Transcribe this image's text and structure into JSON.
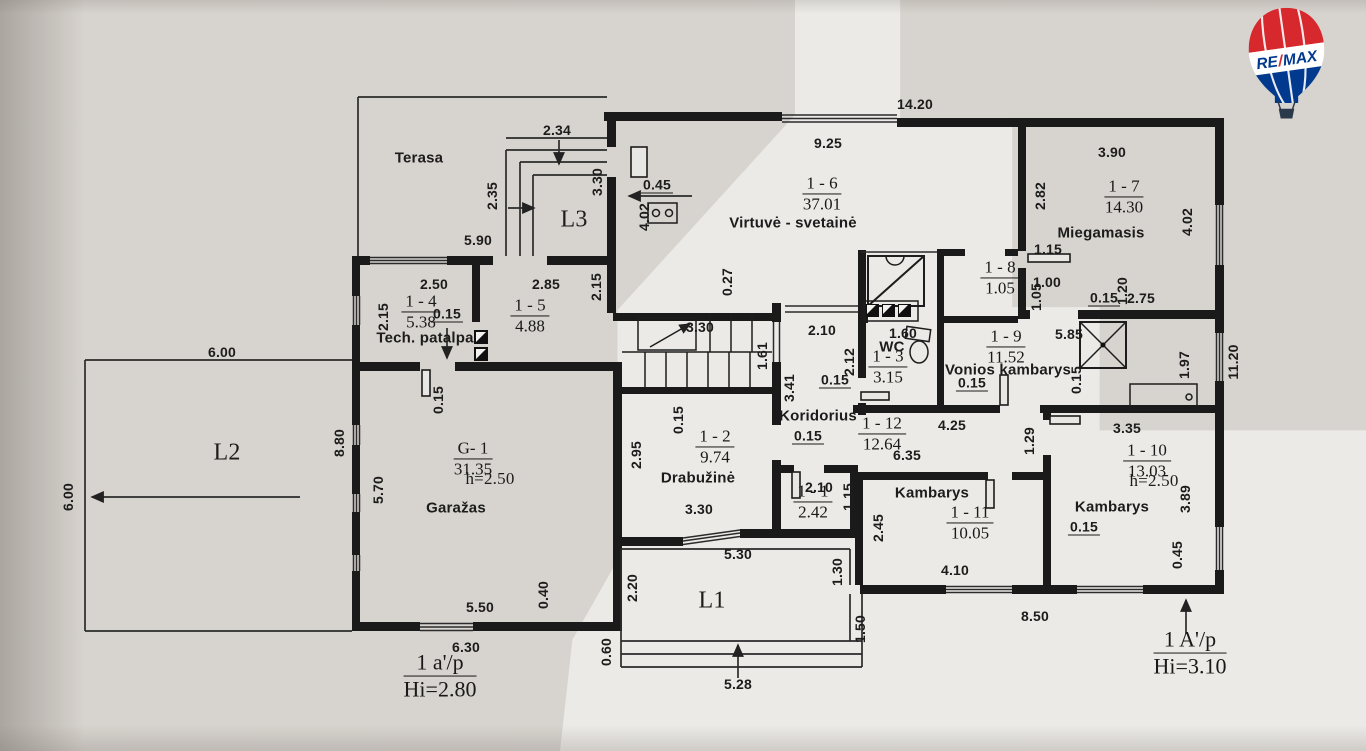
{
  "logo": {
    "re": "RE",
    "slash": "/",
    "max": "MAX",
    "red": "#d7282e",
    "blue": "#00398e",
    "white": "#ffffff",
    "basket": "#2b3a4a"
  },
  "plan": {
    "rooms": [
      {
        "code": "1 - 1",
        "area": "2.42"
      },
      {
        "code": "1 - 2",
        "area": "9.74",
        "name": "Drabužinė"
      },
      {
        "code": "1 - 3",
        "area": "3.15",
        "name": "WC"
      },
      {
        "code": "1 - 4",
        "area": "5.38",
        "name": "Tech. patalpa"
      },
      {
        "code": "1 - 5",
        "area": "4.88"
      },
      {
        "code": "1 - 6",
        "area": "37.01",
        "name": "Virtuvė - svetainė"
      },
      {
        "code": "1 - 7",
        "area": "14.30",
        "name": "Miegamasis"
      },
      {
        "code": "1 - 8",
        "area": "1.05"
      },
      {
        "code": "1 - 9",
        "area": "11.52",
        "name": "Vonios kambarys"
      },
      {
        "code": "1 - 10",
        "area": "13.03",
        "name": "Kambarys",
        "height": "h=2.50"
      },
      {
        "code": "1 - 11",
        "area": "10.05",
        "name": "Kambarys"
      },
      {
        "code": "1 - 12",
        "area": "12.64",
        "name": "Koridorius"
      },
      {
        "code": "G- 1",
        "area": "31.35",
        "name": "Garažas",
        "height": "h=2.50"
      }
    ],
    "zones": [
      "Terasa",
      "L1",
      "L2",
      "L3"
    ],
    "floor_annotations": [
      {
        "label": "1 a'/p",
        "height": "Hi=2.80"
      },
      {
        "label": "1 A'/p",
        "height": "Hi=3.10"
      }
    ],
    "texts": [
      {
        "t": "14.20",
        "x": 915,
        "y": 104
      },
      {
        "t": "2.34",
        "x": 557,
        "y": 130
      },
      {
        "t": "9.25",
        "x": 828,
        "y": 143
      },
      {
        "t": "3.90",
        "x": 1112,
        "y": 152
      },
      {
        "t": "2.35",
        "x": 492,
        "y": 196,
        "v": 1
      },
      {
        "t": "3.30",
        "x": 597,
        "y": 182,
        "v": 1
      },
      {
        "t": "0.45",
        "x": 657,
        "y": 185,
        "u": 1
      },
      {
        "t": "2.82",
        "x": 1040,
        "y": 196,
        "v": 1
      },
      {
        "t": "4.02",
        "x": 644,
        "y": 217,
        "v": 1
      },
      {
        "t": "4.02",
        "x": 1187,
        "y": 222,
        "v": 1
      },
      {
        "t": "5.90",
        "x": 478,
        "y": 240
      },
      {
        "t": "1.15",
        "x": 1048,
        "y": 249
      },
      {
        "t": "1.00",
        "x": 1047,
        "y": 282
      },
      {
        "t": "2.50",
        "x": 434,
        "y": 284
      },
      {
        "t": "2.85",
        "x": 546,
        "y": 284
      },
      {
        "t": "2.15",
        "x": 596,
        "y": 287,
        "v": 1
      },
      {
        "t": "1.05",
        "x": 1036,
        "y": 297,
        "v": 1
      },
      {
        "t": "1.20",
        "x": 1122,
        "y": 291,
        "v": 1
      },
      {
        "t": "0.15",
        "x": 1104,
        "y": 298,
        "u": 1
      },
      {
        "t": "2.75",
        "x": 1141,
        "y": 298
      },
      {
        "t": "0.27",
        "x": 727,
        "y": 282,
        "v": 1
      },
      {
        "t": "0.15",
        "x": 447,
        "y": 314,
        "u": 1
      },
      {
        "t": "2.15",
        "x": 383,
        "y": 317,
        "v": 1
      },
      {
        "t": "6.00",
        "x": 222,
        "y": 352
      },
      {
        "t": "3.30",
        "x": 700,
        "y": 327
      },
      {
        "t": "2.10",
        "x": 822,
        "y": 330
      },
      {
        "t": "1.60",
        "x": 903,
        "y": 333
      },
      {
        "t": "1.61",
        "x": 762,
        "y": 356,
        "v": 1
      },
      {
        "t": "2.12",
        "x": 849,
        "y": 362,
        "v": 1
      },
      {
        "t": "0.15",
        "x": 835,
        "y": 380,
        "u": 1
      },
      {
        "t": "5.85",
        "x": 1069,
        "y": 334
      },
      {
        "t": "0.15",
        "x": 972,
        "y": 383,
        "u": 1
      },
      {
        "t": "0.15",
        "x": 1076,
        "y": 380,
        "v": 1
      },
      {
        "t": "1.97",
        "x": 1184,
        "y": 365,
        "v": 1
      },
      {
        "t": "11.20",
        "x": 1233,
        "y": 362,
        "v": 1
      },
      {
        "t": "3.41",
        "x": 789,
        "y": 388,
        "v": 1
      },
      {
        "t": "0.15",
        "x": 808,
        "y": 436,
        "u": 1
      },
      {
        "t": "6.35",
        "x": 907,
        "y": 455
      },
      {
        "t": "4.25",
        "x": 952,
        "y": 425
      },
      {
        "t": "1.29",
        "x": 1029,
        "y": 441,
        "v": 1
      },
      {
        "t": "3.35",
        "x": 1127,
        "y": 428
      },
      {
        "t": "8.80",
        "x": 339,
        "y": 443,
        "v": 1
      },
      {
        "t": "6.00",
        "x": 68,
        "y": 497,
        "v": 1
      },
      {
        "t": "0.15",
        "x": 438,
        "y": 400,
        "v": 1
      },
      {
        "t": "5.70",
        "x": 378,
        "y": 490,
        "v": 1
      },
      {
        "t": "0.15",
        "x": 678,
        "y": 420,
        "v": 1
      },
      {
        "t": "2.95",
        "x": 636,
        "y": 455,
        "v": 1
      },
      {
        "t": "3.30",
        "x": 699,
        "y": 509
      },
      {
        "t": "2.10",
        "x": 819,
        "y": 487
      },
      {
        "t": "1.15",
        "x": 848,
        "y": 497,
        "v": 1
      },
      {
        "t": "2.45",
        "x": 878,
        "y": 528,
        "v": 1
      },
      {
        "t": "4.10",
        "x": 955,
        "y": 570
      },
      {
        "t": "0.15",
        "x": 1084,
        "y": 527,
        "u": 1
      },
      {
        "t": "3.89",
        "x": 1185,
        "y": 499,
        "v": 1
      },
      {
        "t": "0.45",
        "x": 1177,
        "y": 555,
        "v": 1
      },
      {
        "t": "1.30",
        "x": 837,
        "y": 572,
        "v": 1
      },
      {
        "t": "2.20",
        "x": 632,
        "y": 588,
        "v": 1
      },
      {
        "t": "1.50",
        "x": 860,
        "y": 629,
        "v": 1
      },
      {
        "t": "0.60",
        "x": 606,
        "y": 652,
        "v": 1
      },
      {
        "t": "5.50",
        "x": 480,
        "y": 607
      },
      {
        "t": "0.40",
        "x": 543,
        "y": 595,
        "v": 1
      },
      {
        "t": "6.30",
        "x": 466,
        "y": 647
      },
      {
        "t": "5.30",
        "x": 738,
        "y": 554
      },
      {
        "t": "5.28",
        "x": 738,
        "y": 684
      },
      {
        "t": "8.50",
        "x": 1035,
        "y": 616
      },
      {
        "t": "Terasa",
        "x": 419,
        "y": 158,
        "k": "room"
      },
      {
        "t": "Virtuvė  -  svetainė",
        "x": 793,
        "y": 223,
        "k": "room"
      },
      {
        "t": "Miegamasis",
        "x": 1101,
        "y": 233,
        "k": "room"
      },
      {
        "t": "Tech. patalpa",
        "x": 425,
        "y": 338,
        "k": "room"
      },
      {
        "t": "WC",
        "x": 892,
        "y": 347,
        "k": "room"
      },
      {
        "t": "Vonios kambarys",
        "x": 1008,
        "y": 370,
        "k": "room"
      },
      {
        "t": "Koridorius",
        "x": 818,
        "y": 416,
        "k": "room"
      },
      {
        "t": "Drabužinė",
        "x": 698,
        "y": 478,
        "k": "room"
      },
      {
        "t": "Garažas",
        "x": 456,
        "y": 508,
        "k": "room"
      },
      {
        "t": "Kambarys",
        "x": 932,
        "y": 493,
        "k": "room"
      },
      {
        "t": "Kambarys",
        "x": 1112,
        "y": 507,
        "k": "room"
      },
      {
        "t": "L3",
        "x": 574,
        "y": 220,
        "k": "zone"
      },
      {
        "t": "L2",
        "x": 227,
        "y": 453,
        "k": "zone"
      },
      {
        "t": "L1",
        "x": 712,
        "y": 601,
        "k": "zone"
      },
      {
        "t": "h=2.50",
        "x": 490,
        "y": 479,
        "k": "hh"
      },
      {
        "t": "h=2.50",
        "x": 1154,
        "y": 481,
        "k": "hh"
      }
    ],
    "fractions": [
      {
        "a": "1 - 6",
        "b": "37.01",
        "x": 822,
        "y": 194
      },
      {
        "a": "1 - 7",
        "b": "14.30",
        "x": 1124,
        "y": 197
      },
      {
        "a": "1 - 8",
        "b": "1.05",
        "x": 1000,
        "y": 278
      },
      {
        "a": "1 - 4",
        "b": "5.38",
        "x": 421,
        "y": 312
      },
      {
        "a": "1 - 5",
        "b": "4.88",
        "x": 530,
        "y": 316
      },
      {
        "a": "1 - 3",
        "b": "3.15",
        "x": 888,
        "y": 367
      },
      {
        "a": "1 - 9",
        "b": "11.52",
        "x": 1006,
        "y": 347
      },
      {
        "a": "1 - 12",
        "b": "12.64",
        "x": 882,
        "y": 434
      },
      {
        "a": "1 - 2",
        "b": "9.74",
        "x": 715,
        "y": 447
      },
      {
        "a": "1 - 1",
        "b": "2.42",
        "x": 813,
        "y": 502
      },
      {
        "a": "1 - 11",
        "b": "10.05",
        "x": 970,
        "y": 523
      },
      {
        "a": "1 - 10",
        "b": "13.03",
        "x": 1147,
        "y": 461
      },
      {
        "a": "G- 1",
        "b": "31.35",
        "x": 473,
        "y": 459
      },
      {
        "a": "1 a'/p",
        "b": "Hi=2.80",
        "x": 440,
        "y": 676,
        "big": 1,
        "n": "section-annotation-left"
      },
      {
        "a": "1 A'/p",
        "b": "Hi=3.10",
        "x": 1190,
        "y": 653,
        "big": 1,
        "n": "section-annotation-right"
      }
    ]
  }
}
